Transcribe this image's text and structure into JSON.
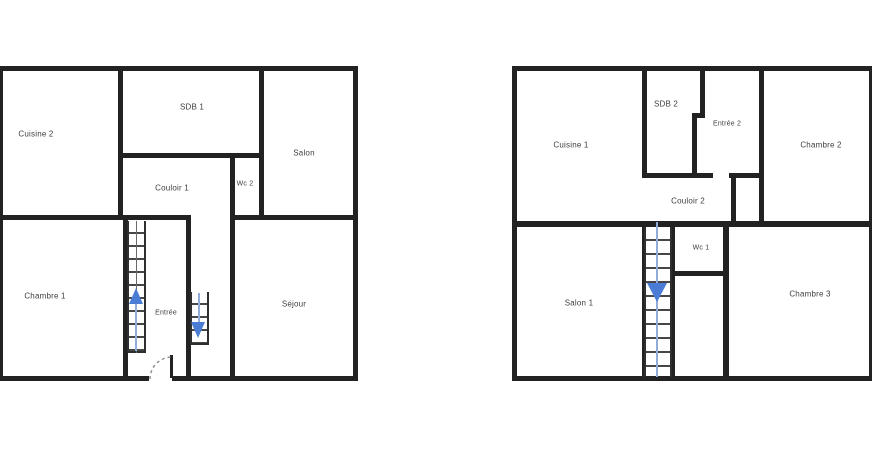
{
  "title": "Plans d'étage (deux niveaux)",
  "colors": {
    "background": "#ffffff",
    "wall": "#222222",
    "stair_step": "#474747",
    "stair_arrow_blue": "#4a7cd6",
    "stair_guide_blue": "#93abdc",
    "label_text": "#3d3d3d",
    "door_arc": "#8a8a8a"
  },
  "plan_left": {
    "rooms": {
      "cuisine2": "Cuisine 2",
      "sdb1": "SDB 1",
      "salon": "Salon",
      "couloir1": "Couloir 1",
      "wc2": "Wc 2",
      "chambre1": "Chambre 1",
      "entree": "Entrée",
      "sejour": "Séjour"
    },
    "stairs": [
      {
        "name": "grand-escalier",
        "direction": "up",
        "icon": "stairs-up-arrow-icon"
      },
      {
        "name": "petit-escalier",
        "direction": "down",
        "icon": "stairs-down-arrow-icon"
      }
    ],
    "door": {
      "name": "porte-entree",
      "icon": "door-swing-arc-icon"
    }
  },
  "plan_right": {
    "rooms": {
      "cuisine1": "Cuisine 1",
      "sdb2": "SDB 2",
      "entree2": "Entrée 2",
      "chambre2": "Chambre 2",
      "couloir2": "Couloir 2",
      "wc1": "Wc 1",
      "salon1": "Salon 1",
      "chambre3": "Chambre 3"
    },
    "stairs": [
      {
        "name": "escalier",
        "direction": "down",
        "icon": "stairs-down-arrow-icon"
      }
    ]
  }
}
